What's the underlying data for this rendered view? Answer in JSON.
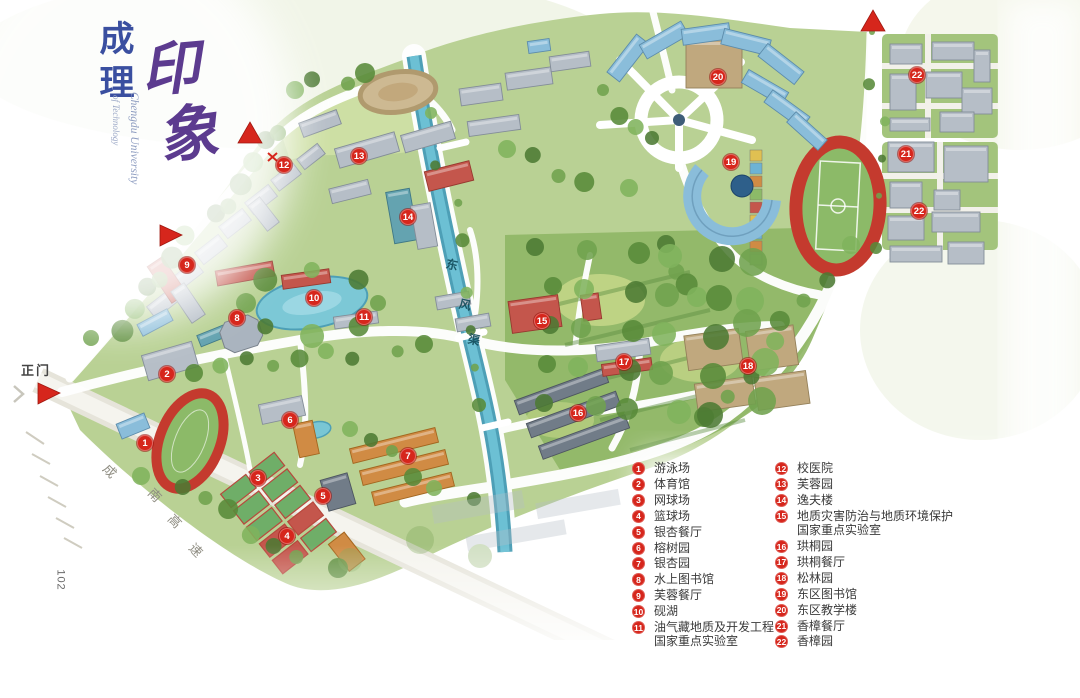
{
  "title": {
    "cn_vertical": "成理",
    "cn_calligraphy": "印象",
    "en_line1": "Chengdu University",
    "en_line2": "of Technology"
  },
  "labels": {
    "main_gate": "正门",
    "highway": "成南高速",
    "canal": "东风渠",
    "page_number": "102"
  },
  "colors": {
    "marker_red": "#d6261c",
    "title_blue": "#3a4fa0",
    "title_purple": "#5c3b8f",
    "track_red": "#c43a2e",
    "river_blue": "#5db3c9"
  },
  "map_markers": [
    {
      "n": "1",
      "x": 145,
      "y": 443
    },
    {
      "n": "2",
      "x": 167,
      "y": 374
    },
    {
      "n": "3",
      "x": 258,
      "y": 478
    },
    {
      "n": "4",
      "x": 287,
      "y": 536
    },
    {
      "n": "5",
      "x": 323,
      "y": 496
    },
    {
      "n": "6",
      "x": 290,
      "y": 420
    },
    {
      "n": "7",
      "x": 408,
      "y": 456
    },
    {
      "n": "8",
      "x": 237,
      "y": 318
    },
    {
      "n": "9",
      "x": 187,
      "y": 265
    },
    {
      "n": "10",
      "x": 314,
      "y": 298
    },
    {
      "n": "11",
      "x": 364,
      "y": 317
    },
    {
      "n": "12",
      "x": 284,
      "y": 165
    },
    {
      "n": "13",
      "x": 359,
      "y": 156
    },
    {
      "n": "14",
      "x": 408,
      "y": 217
    },
    {
      "n": "15",
      "x": 542,
      "y": 321
    },
    {
      "n": "16",
      "x": 578,
      "y": 413
    },
    {
      "n": "17",
      "x": 624,
      "y": 362
    },
    {
      "n": "18",
      "x": 748,
      "y": 366
    },
    {
      "n": "19",
      "x": 731,
      "y": 162
    },
    {
      "n": "20",
      "x": 718,
      "y": 77
    },
    {
      "n": "21",
      "x": 906,
      "y": 154
    },
    {
      "n": "22",
      "x": 917,
      "y": 75
    },
    {
      "n": "22",
      "x": 919,
      "y": 211
    }
  ],
  "legend": {
    "left": [
      {
        "n": "1",
        "lines": [
          "游泳场"
        ]
      },
      {
        "n": "2",
        "lines": [
          "体育馆"
        ]
      },
      {
        "n": "3",
        "lines": [
          "网球场"
        ]
      },
      {
        "n": "4",
        "lines": [
          "篮球场"
        ]
      },
      {
        "n": "5",
        "lines": [
          "银杏餐厅"
        ]
      },
      {
        "n": "6",
        "lines": [
          "榕树园"
        ]
      },
      {
        "n": "7",
        "lines": [
          "银杏园"
        ]
      },
      {
        "n": "8",
        "lines": [
          "水上图书馆"
        ]
      },
      {
        "n": "9",
        "lines": [
          "芙蓉餐厅"
        ]
      },
      {
        "n": "10",
        "lines": [
          "砚湖"
        ]
      },
      {
        "n": "11",
        "lines": [
          "油气藏地质及开发工程",
          "国家重点实验室"
        ]
      }
    ],
    "right": [
      {
        "n": "12",
        "lines": [
          "校医院"
        ]
      },
      {
        "n": "13",
        "lines": [
          "芙蓉园"
        ]
      },
      {
        "n": "14",
        "lines": [
          "逸夫楼"
        ]
      },
      {
        "n": "15",
        "lines": [
          "地质灾害防治与地质环境保护",
          "国家重点实验室"
        ]
      },
      {
        "n": "16",
        "lines": [
          "珙桐园"
        ]
      },
      {
        "n": "17",
        "lines": [
          "珙桐餐厅"
        ]
      },
      {
        "n": "18",
        "lines": [
          "松林园"
        ]
      },
      {
        "n": "19",
        "lines": [
          "东区图书馆"
        ]
      },
      {
        "n": "20",
        "lines": [
          "东区教学楼"
        ]
      },
      {
        "n": "21",
        "lines": [
          "香樟餐厅"
        ]
      },
      {
        "n": "22",
        "lines": [
          "香樟园"
        ]
      }
    ]
  }
}
